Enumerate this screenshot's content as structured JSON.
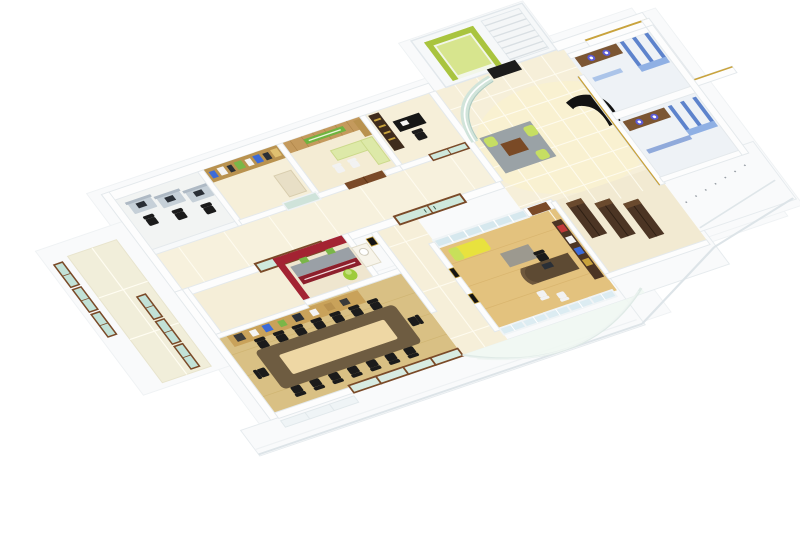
{
  "scene": {
    "type": "3d-floor-plan-render",
    "view": "isometric-cutaway-office",
    "background": "#ffffff"
  },
  "palette": {
    "background": "#ffffff",
    "wall": "#fdfdfd",
    "wall_edge": "#e4e9ec",
    "wall_shade": "#dfe6ea",
    "deck": "#f9fafb",
    "deck_edge": "#dde4e8",
    "tile_floor": "#f6efd9",
    "tile_glow": "#fcf3cb",
    "grout": "#fffdf2",
    "cool_floor": "#f2f4f3",
    "wood_floor": "#d9c084",
    "wood_plank": "#c9ad66",
    "office_wood": "#e3c27e",
    "table_dark": "#6e5c41",
    "table_inner": "#eed7a4",
    "chair_black": "#1b1b1b",
    "credenza_wood": "#c9a25a",
    "shelf_wood": "#b9924f",
    "panel_wood": "#c49a5d",
    "sign_green": "#6fb43f",
    "lime": "#c6de62",
    "lime_light": "#dde9a8",
    "lift_green": "#a9c43e",
    "lift_floor": "#d7e58e",
    "red_wall": "#a32332",
    "red_cabinet": "#8d1f2c",
    "counter_gray": "#9aa0a6",
    "glass_teal": "#c2e2d8",
    "frame_brown": "#7a4a28",
    "glass_blue": "#dcecf2",
    "frame_white": "#f0f4f6",
    "wardrobe": "#4c3524",
    "wardrobe_top": "#6a4a2e",
    "stall_blue": "#5d83cc",
    "stall_blue_light": "#8fb0e4",
    "vanity_brown": "#7c5633",
    "sink_blue": "#5b5bd6",
    "desk_gray": "#c6d0d8",
    "monitor_dark": "#2a2f36",
    "sofa_black": "#121212",
    "gold": "#c9a33c",
    "rug_gray": "#9aa2a6",
    "door_wood": "#7a4a28",
    "white_chair": "#f2f2f2"
  },
  "rooms": [
    {
      "name": "entry-lounge",
      "floor": "cream-tile",
      "furniture": {
        "rug": 1,
        "coffee_table": 1,
        "lime_poufs": 2,
        "black_sofa": 1
      }
    },
    {
      "name": "lift-and-stairs",
      "lift_color": "green",
      "stair_steps": 7
    },
    {
      "name": "workstation-row",
      "desks": 3,
      "chairs": 3
    },
    {
      "name": "library-cabin",
      "bookshelf_wall": 1
    },
    {
      "name": "wood-panel-cabin",
      "green_signboard": 1,
      "lime_desk": 1
    },
    {
      "name": "dark-cabin",
      "black_desk": 1,
      "dark_shelf": 1
    },
    {
      "name": "red-pantry",
      "counter": 1,
      "water_cooler": 1
    },
    {
      "name": "conference-room",
      "table": 1,
      "chairs": 16,
      "credenza": 1
    },
    {
      "name": "manager-office",
      "curved_desk": 1,
      "office_chair": 1,
      "guest_chairs": 2,
      "yellow_chaise": 1,
      "wall_frames": 2
    },
    {
      "name": "storage-room",
      "wardrobes": 3
    },
    {
      "name": "restrooms",
      "stall_rows": 2,
      "stalls": 6,
      "sinks": 4
    },
    {
      "name": "left-balcony",
      "teal_glass_panels": 6
    },
    {
      "name": "front-atrium",
      "curved_glass": 1
    },
    {
      "name": "conference-terrace",
      "brown_glass_panels": 4
    }
  ]
}
